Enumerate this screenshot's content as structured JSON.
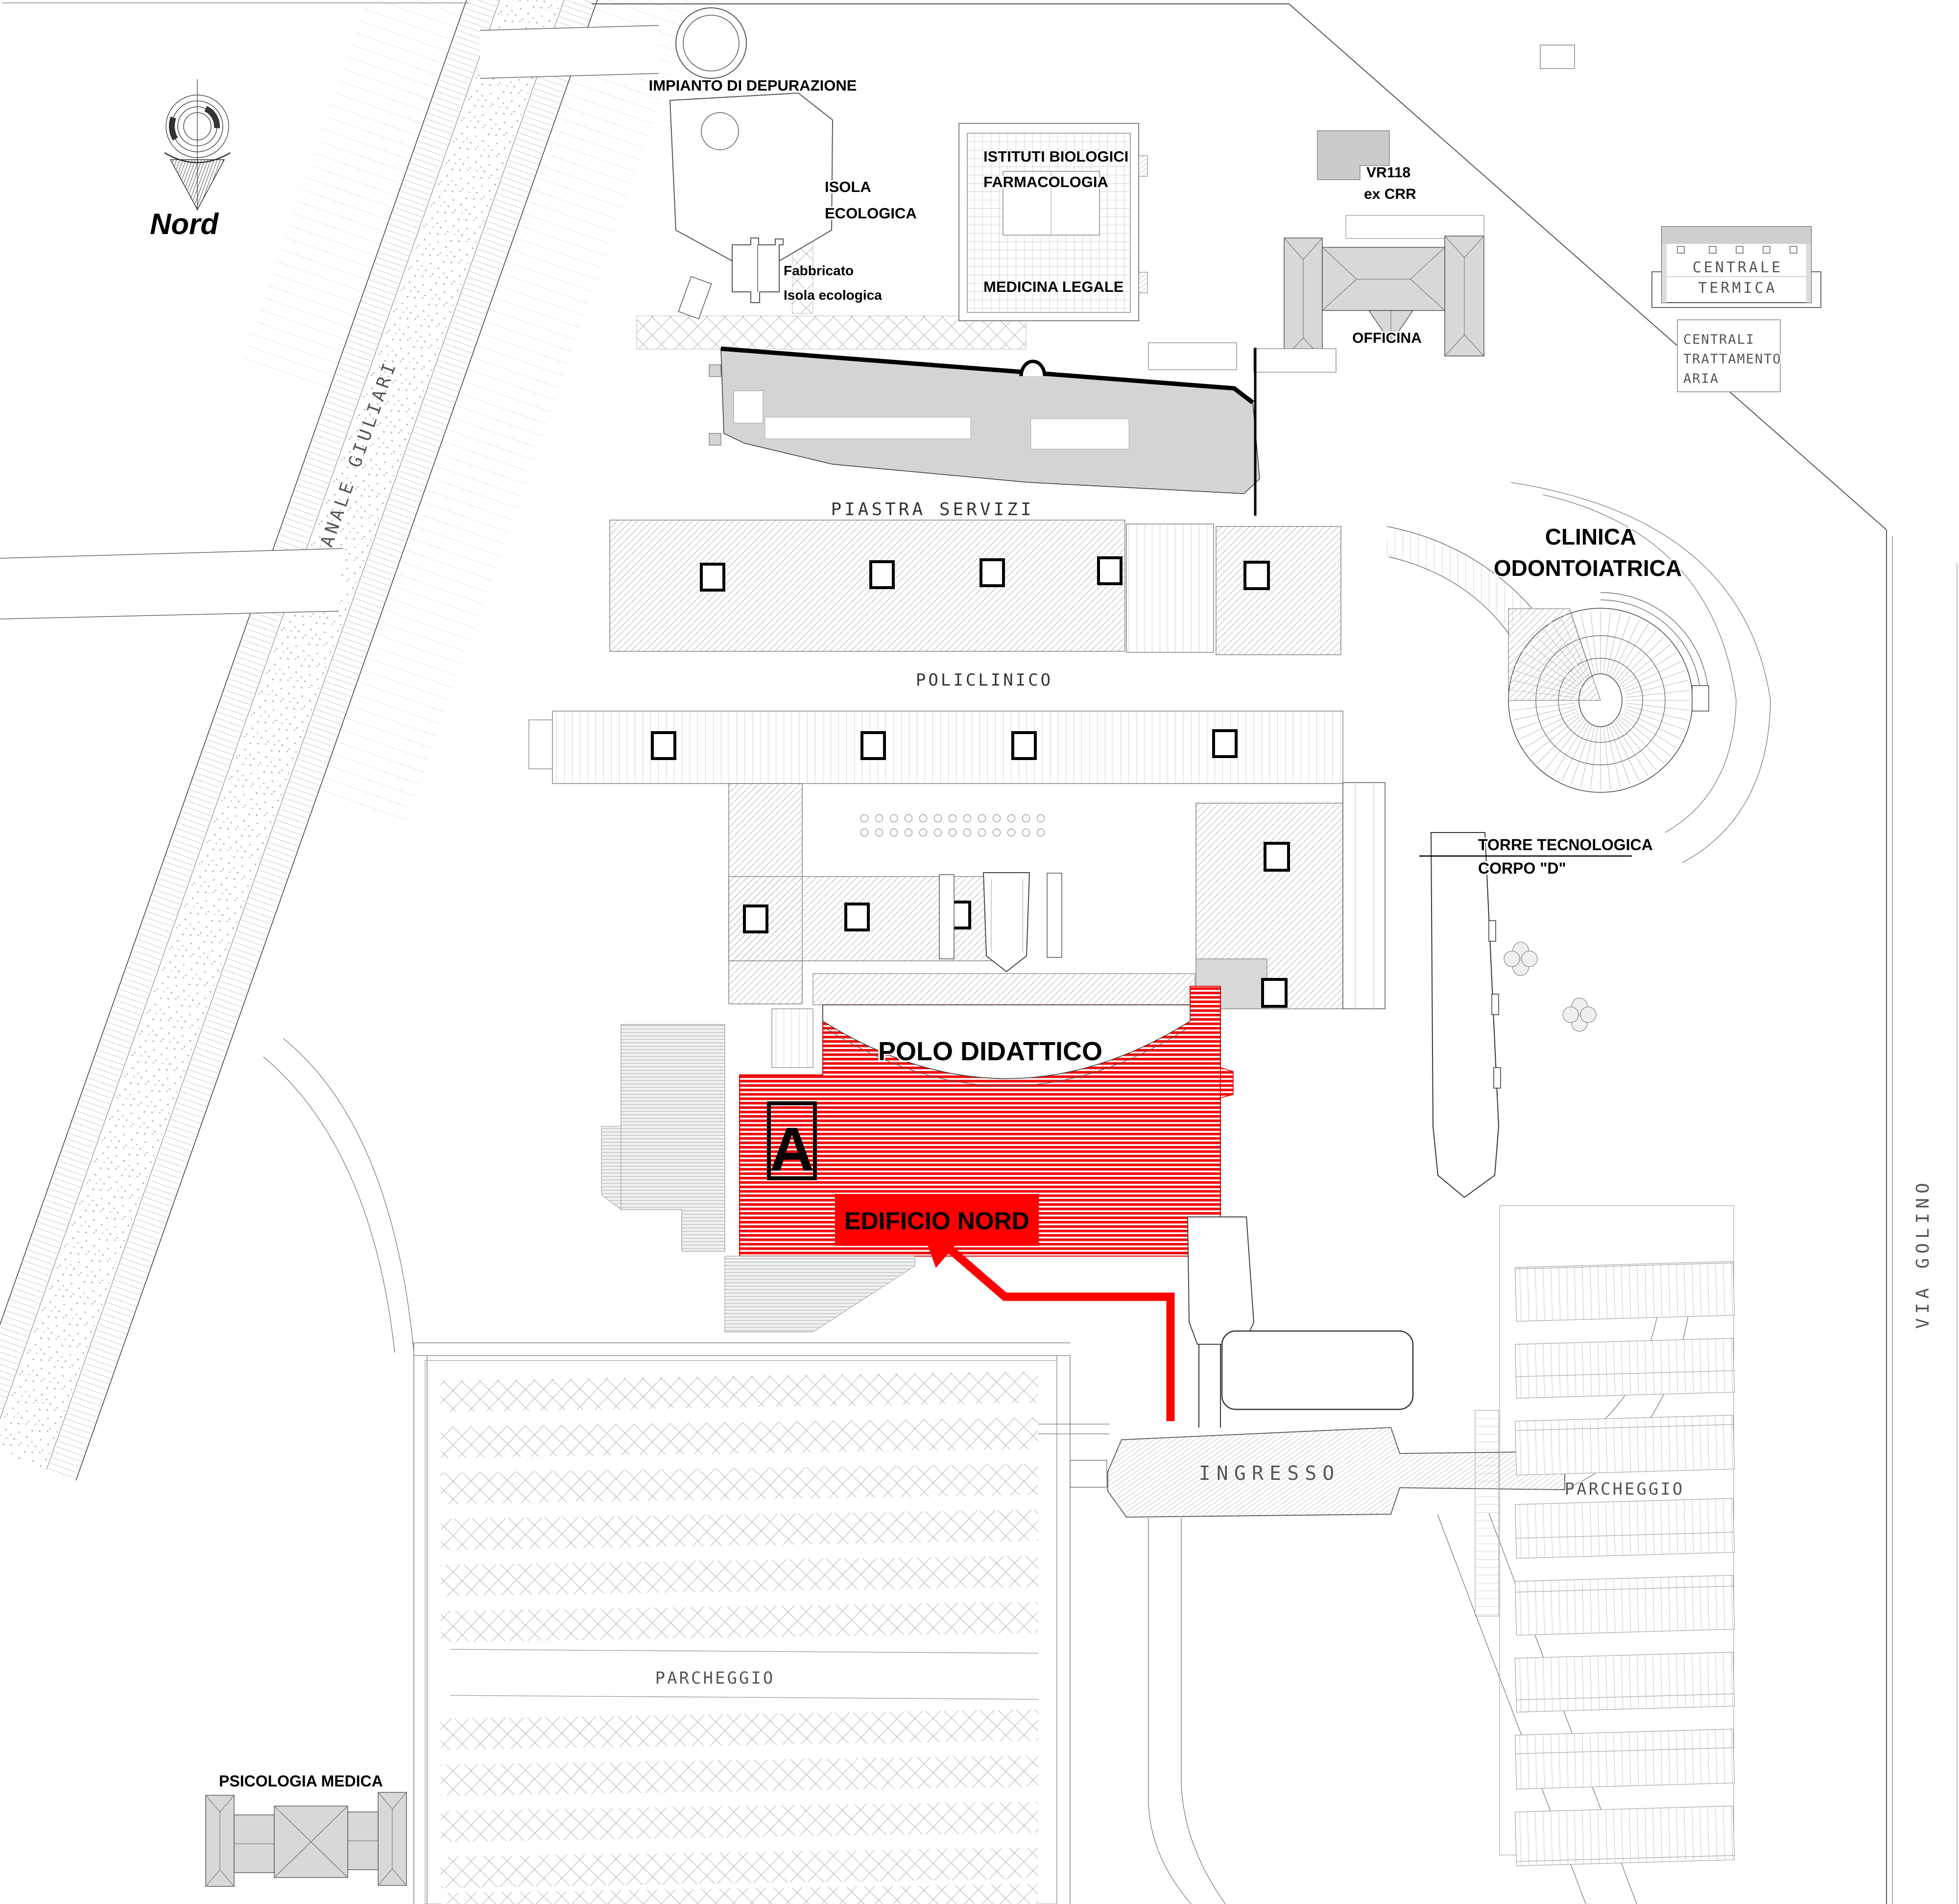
{
  "map_type": "campus site plan",
  "colors": {
    "highlight_red": "#ff0000",
    "stripe_red": "#f20d0d",
    "route_red": "#ff0000",
    "letter_a_dark": "#1d3349",
    "roof_gray": "#d6d6d6",
    "hatch_gray": "#b8b8b8",
    "line_black": "#000000"
  },
  "compass": {
    "label": "Nord"
  },
  "labels": {
    "impianto": "IMPIANTO DI DEPURAZIONE",
    "isola1": "ISOLA",
    "isola2": "ECOLOGICA",
    "fabbricato1": "Fabbricato",
    "fabbricato2": "Isola ecologica",
    "istituti1": "ISTITUTI BIOLOGICI",
    "istituti2": "FARMACOLOGIA",
    "medicina": "MEDICINA LEGALE",
    "vr1": "VR118",
    "vr2": "ex CRR",
    "officina": "OFFICINA",
    "centrale1": "CENTRALE",
    "centrale2": "TERMICA",
    "centrali1": "CENTRALI",
    "centrali2": "TRATTAMENTO",
    "centrali3": "ARIA",
    "canale": "CANALE GIULIARI",
    "piastra": "PIASTRA SERVIZI",
    "policlinico": "POLICLINICO",
    "clinica1": "CLINICA",
    "clinica2": "ODONTOIATRICA",
    "torre1": "TORRE TECNOLOGICA",
    "torre2": "CORPO \"D\"",
    "polo": "POLO DIDATTICO",
    "edificio_a": "A",
    "edificio_nord": "EDIFICIO NORD",
    "via_golino": "VIA GOLINO",
    "ingresso": "INGRESSO",
    "parcheggio_right": "PARCHEGGIO",
    "parcheggio_bottom": "PARCHEGGIO",
    "psicologia": "PSICOLOGIA MEDICA"
  }
}
